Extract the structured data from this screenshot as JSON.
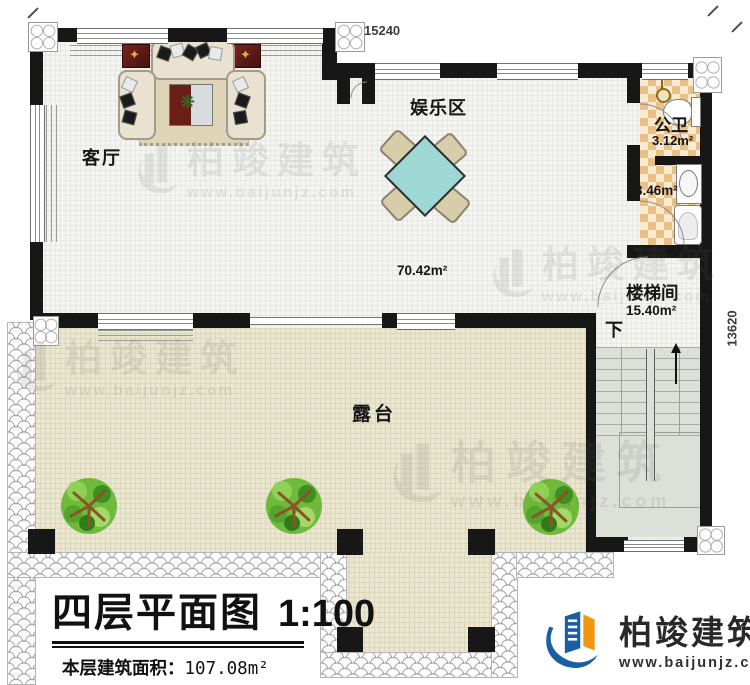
{
  "title_block": {
    "title": "四层平面图",
    "scale": "1:100",
    "area_label": "本层建筑面积：",
    "area_value": "107.08m²",
    "floor_height_label": "层高：",
    "floor_height_value": "3.0m"
  },
  "dimensions": {
    "top": "15240",
    "right": "13620"
  },
  "rooms": {
    "living_room": "客厅",
    "entertainment": "娱乐区",
    "entertainment_area": "70.42m²",
    "bathroom": "公卫",
    "bathroom_area": "3.12m²",
    "washroom_area": "3.46m²",
    "stairwell": "楼梯间",
    "stairwell_area": "15.40m²",
    "stairs_down": "下",
    "terrace": "露台"
  },
  "branding": {
    "company": "柏竣建筑",
    "website": "www.baijunjz.com"
  },
  "watermark": {
    "company": "柏竣建筑",
    "website": "www.baijunjz.com"
  },
  "colors": {
    "wall": "#171717",
    "interior_floor": "#f4f4f1",
    "terrace_floor": "#eae6cf",
    "bath_checker_orange": "#eac184",
    "stair_gray_green": "#dce0d6",
    "game_table_teal": "#9ed8d4",
    "logo_blue": "#1a5ea6",
    "logo_orange": "#f2960f"
  }
}
